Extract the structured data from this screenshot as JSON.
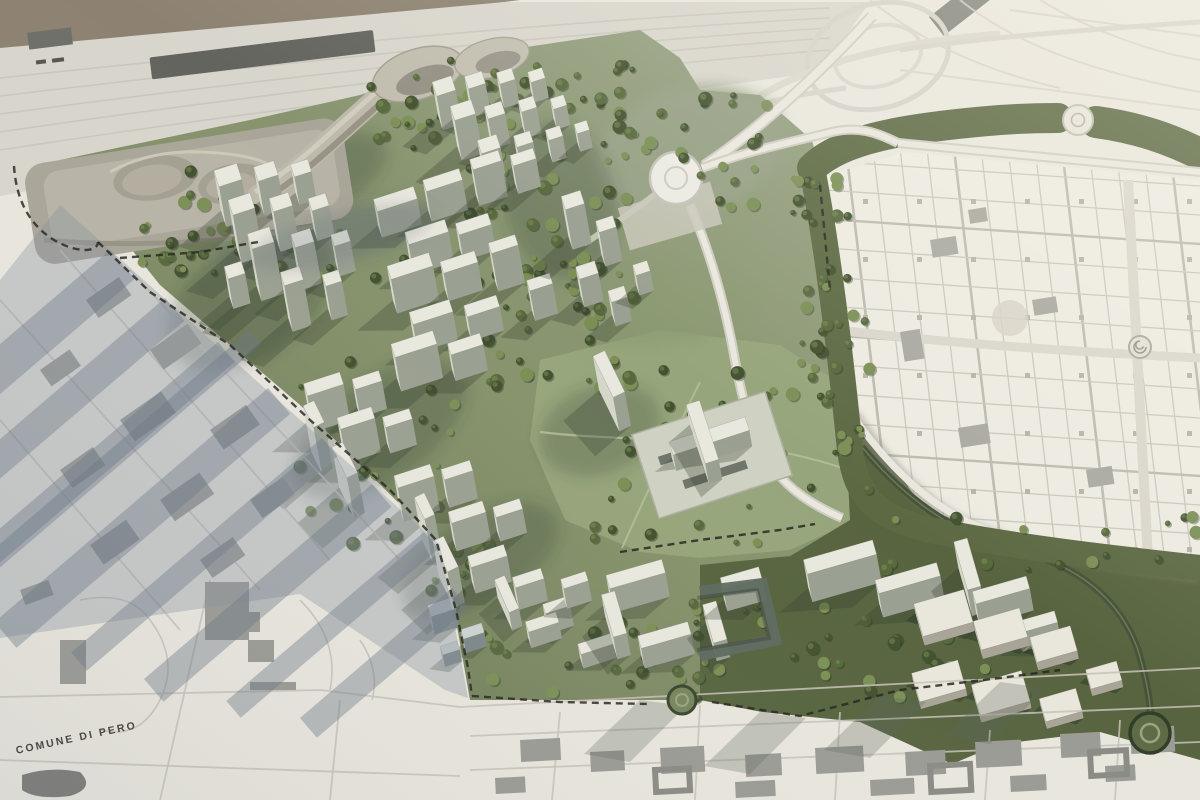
{
  "map": {
    "label_comune": "COMUNE DI PERO"
  },
  "palette": {
    "paper": "#e9e6dd",
    "paper_bright": "#f1eee5",
    "band": "#d8d5cc",
    "rail_line": "#c6c3b9",
    "brown_corner": "#8d8271",
    "slab_dark": "#63645e",
    "site_green": "#929e7c",
    "site_green_dark": "#6d7a53",
    "lawn": "#97a57b",
    "belt_green": "#5c6943",
    "field_green": "#57643f",
    "road_dark": "#46523a",
    "tree_dark": "#42512f",
    "tree_mid": "#57683c",
    "tree_light": "#7b8f55",
    "bldg_top": "#e9e8de",
    "bldg_lit": "#d6d7cb",
    "bldg_shade": "#9aa091",
    "bldg_shadow": "rgba(52,64,46,0.30)",
    "podium": "#b7b3a6",
    "podium_dark": "#8f8b7e",
    "podium_light": "#cfcaba",
    "town_block": "#9b9b95",
    "town_block_dark": "#7f7f7a",
    "town_street": "#c5c2b8",
    "shadow_blue": "rgba(133,145,158,0.34)",
    "shadow_blue_dark": "rgba(104,117,132,0.40)",
    "grid_line": "#c9c6bb",
    "grid_bg": "#edebe1",
    "road_white": "#e9e7de",
    "road_casing": "#cfccc1",
    "boundary": "#26261f",
    "label_color": "#4a4841"
  }
}
